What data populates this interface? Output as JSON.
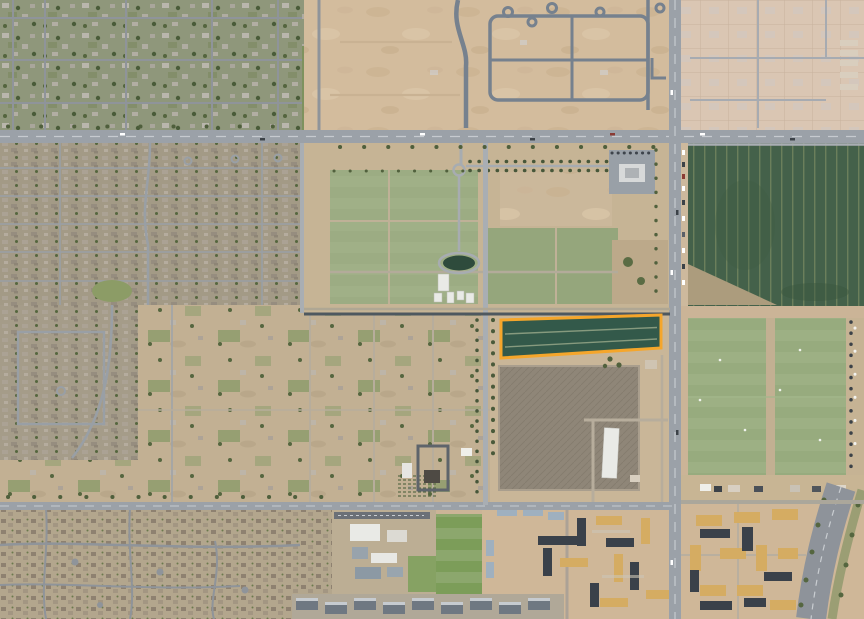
{
  "map": {
    "kind": "aerial-satellite-photo",
    "viewport": {
      "width": 864,
      "height": 619
    },
    "parcel_highlight": {
      "name": "outlined-parcel",
      "shape": "quadrilateral",
      "outline_color": "#F5A62B",
      "fill_color": "#33594A",
      "outline_width": 3
    },
    "colors": {
      "desert_base": "#CBB497",
      "nw_residential": "#8F977B",
      "farm_strip": "#7E925F",
      "graded_dirt": "#D3BC9D",
      "graded_dirt_light": "#DAC6B3",
      "suburb": "#A39A86",
      "suburb_south": "#A59C89",
      "rural": "#C2B093",
      "memorial_base": "#C6B495",
      "park_lawn": "#9CAC83",
      "park_lawn_2": "#95A67C",
      "pond": "#2E4B3C",
      "canal": "#4E585F",
      "crop_field": "#44614A",
      "sports_field": "#97AB7E",
      "plowed_field": "#8F8678",
      "road_arterial": "#9BA1A8",
      "road_new": "#76818E",
      "road_dirt": "#B7AD9C",
      "dense_subdivision": "#B3A68D",
      "apartments_dirt": "#CFB798",
      "building_tan": "#D5AC62",
      "building_dark": "#3A414A",
      "building_white": "#E9EAE6",
      "building_gray": "#8C99A4",
      "freeway": "#8E939A",
      "school_field": "#7C9D59",
      "tree_green": "#4F5F3C"
    },
    "regions": [
      {
        "id": "nw-residential",
        "kind": "established-residential"
      },
      {
        "id": "graded-development",
        "kind": "subdivision-under-construction"
      },
      {
        "id": "dirt-lots-northeast",
        "kind": "graded-lots"
      },
      {
        "id": "suburb-west",
        "kind": "tract-housing"
      },
      {
        "id": "suburb-southwest",
        "kind": "tract-housing"
      },
      {
        "id": "rural-acreage",
        "kind": "large-lot-rural"
      },
      {
        "id": "memorial-park",
        "kind": "landscaped-park-with-pond"
      },
      {
        "id": "crop-field",
        "kind": "row-crop-field"
      },
      {
        "id": "sports-fields",
        "kind": "grass-sports-fields"
      },
      {
        "id": "plowed-field",
        "kind": "plowed-dirt-field"
      },
      {
        "id": "apartments-construction",
        "kind": "apartments-under-construction"
      },
      {
        "id": "apartments-east",
        "kind": "apartment-complex"
      },
      {
        "id": "subdivision-south",
        "kind": "dense-subdivision"
      },
      {
        "id": "school-campus",
        "kind": "school"
      },
      {
        "id": "freeway-curve",
        "kind": "curving-parkway"
      }
    ]
  }
}
